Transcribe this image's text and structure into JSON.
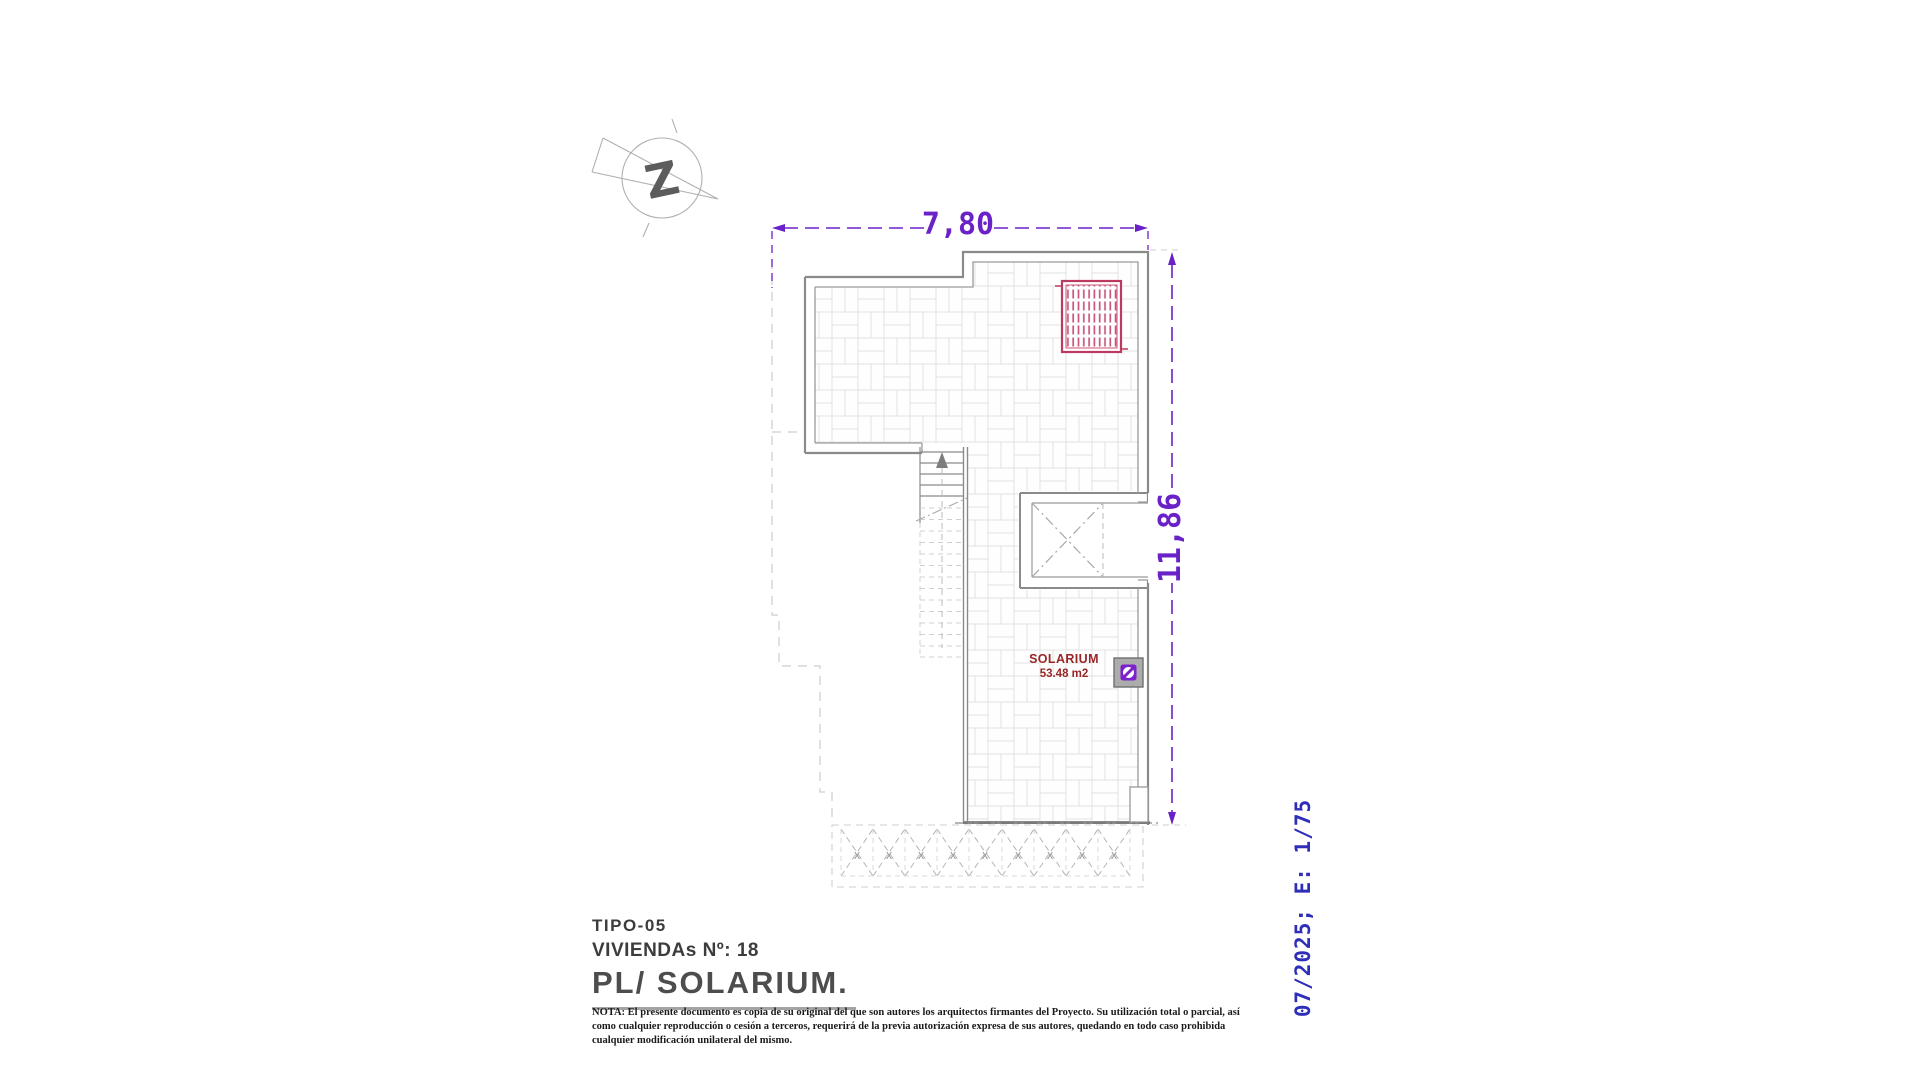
{
  "dimensions": {
    "width_label": "7,80",
    "height_label": "11,86"
  },
  "room": {
    "name": "SOLARIUM",
    "area": "53.48 m2"
  },
  "compass": {
    "glyph": "Z"
  },
  "pergola": {
    "mark": "X"
  },
  "side_note": {
    "text": "07/2025; E: 1/75"
  },
  "title_block": {
    "line1": "TIPO-05",
    "line2": "VIVIENDAs Nº: 18",
    "line3": "PL/ SOLARIUM."
  },
  "nota": {
    "lines": [
      "NOTA: El presente documento es copia de su original del que son autores los arquitectos firmantes del Proyecto. Su utilización total o parcial, así",
      "como cualquier reproducción o cesión a terceros, requerirá  de la previa autorización expresa de sus autores, quedando en todo caso prohibida",
      "cualquier modificación unilateral del mismo."
    ]
  },
  "colors": {
    "dimension_purple": "#6b21c8",
    "note_blue": "#2e2eb8",
    "label_red": "#9a2626",
    "panel_pink": "#bc3a60",
    "icon_purple": "#7c22cc",
    "wall_gray": "#8a8a8a"
  }
}
